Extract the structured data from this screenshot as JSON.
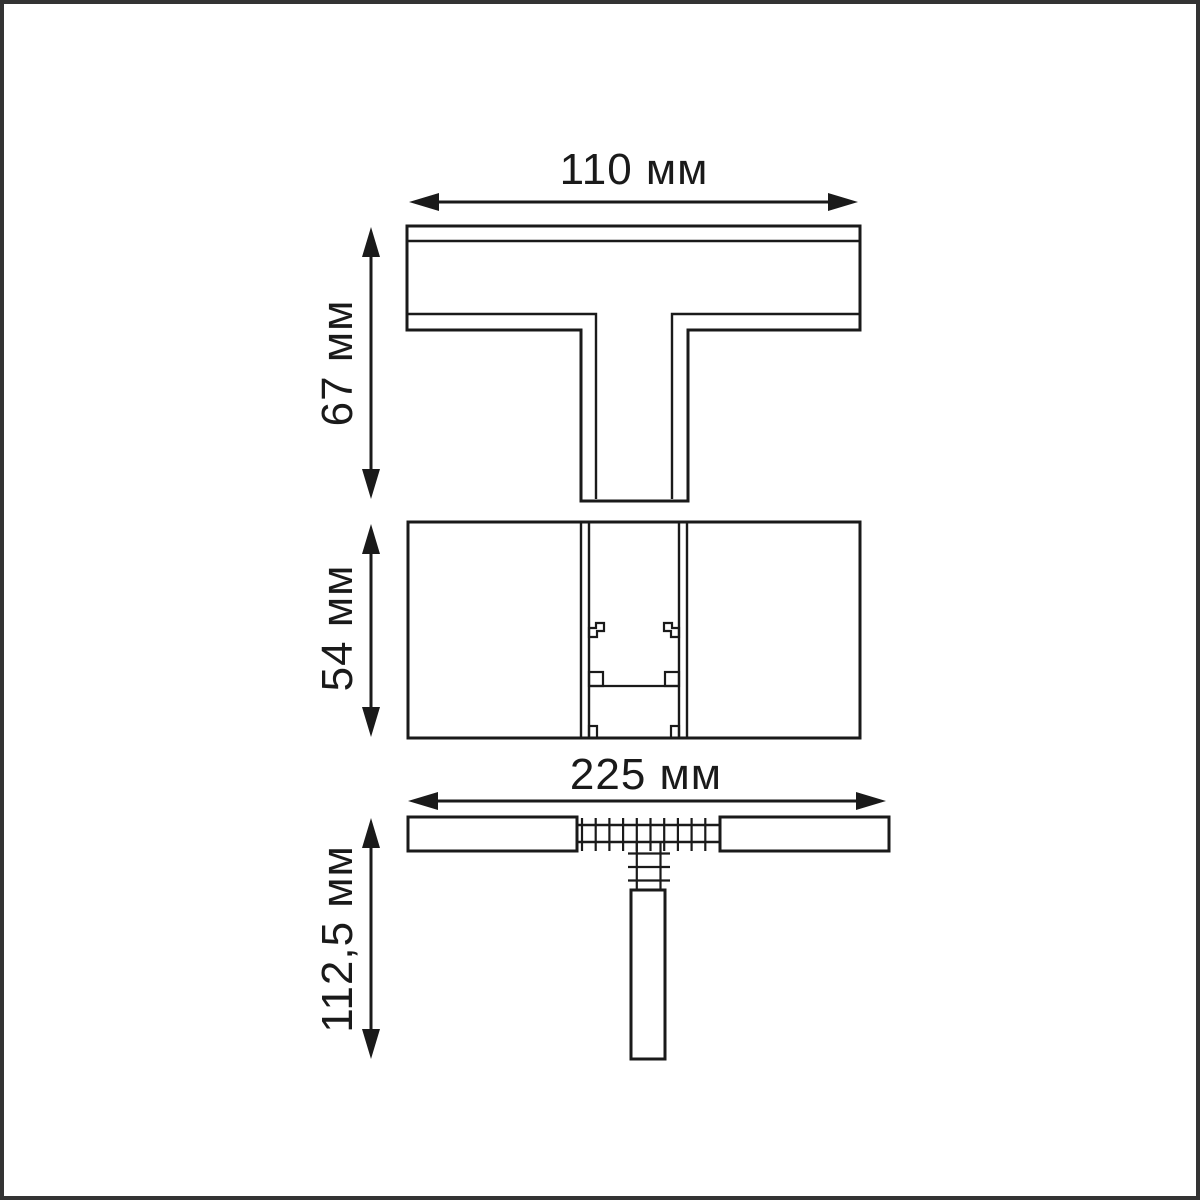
{
  "colors": {
    "background": "#ffffff",
    "frame_border": "#333333",
    "line": "#1a1a1a",
    "text": "#1a1a1a"
  },
  "drawing": {
    "unit": "мм",
    "dimension_labels": {
      "top_view_width": {
        "label": "110 мм",
        "value_mm": 110
      },
      "top_view_height": {
        "label": "67 мм",
        "value_mm": 67
      },
      "side_view_height": {
        "label": "54 мм",
        "value_mm": 54
      },
      "front_view_width": {
        "label": "225 мм",
        "value_mm": 225
      },
      "front_view_height": {
        "label": "112,5 мм",
        "value_mm": 112.5
      }
    }
  }
}
